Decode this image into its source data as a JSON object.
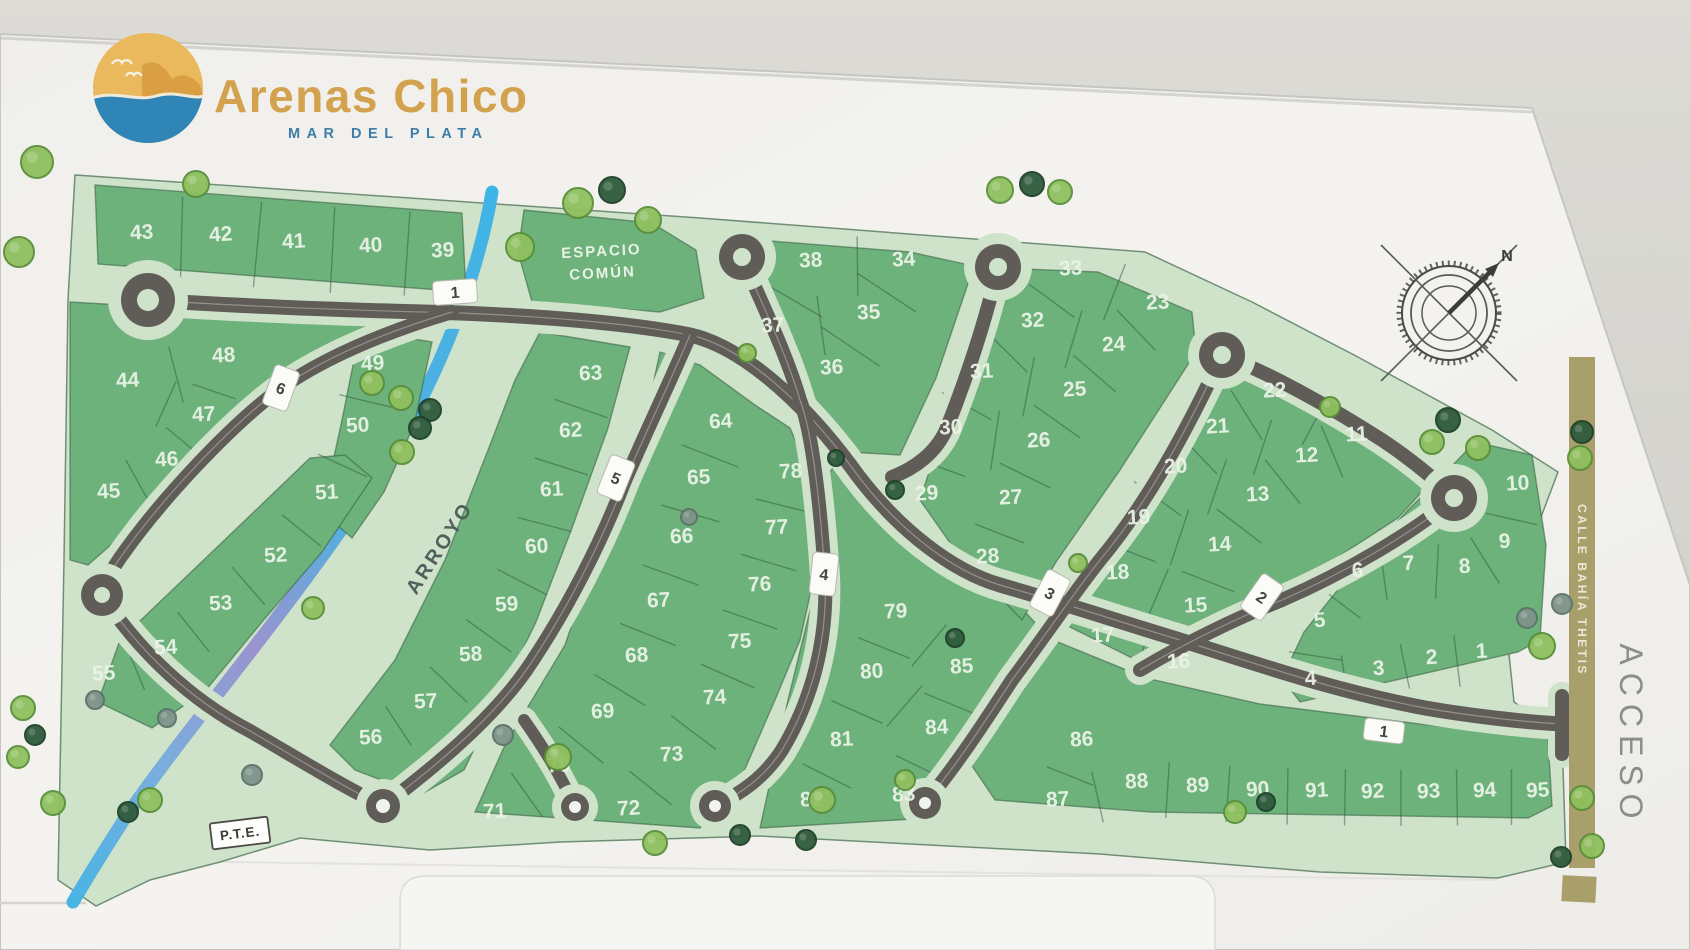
{
  "title": {
    "name": "Arenas Chico",
    "subtitle": "MAR DEL PLATA"
  },
  "map": {
    "common_space_line1": "ESPACIO",
    "common_space_line2": "COMÚN",
    "stream_label": "ARROYO",
    "street_side_label": "CALLE BAHÍA THETIS",
    "access_label": "ACCESO",
    "pte_label": "P.T.E.",
    "north_label": "N",
    "colors": {
      "lot_green": "#6db17b",
      "verge_green": "#cfe2ca",
      "road_gray": "#605c57",
      "stream_blue": "#41b4e6",
      "stream_lavender": "#9a93cf",
      "calle_olive": "#a89f6b",
      "brand_gold": "#d2a24f",
      "brand_blue": "#3c7ea7",
      "wall": "#d7d6d1",
      "board_white": "#f2f1ed",
      "tree_light": "#8fc05f",
      "tree_dark": "#2f5b3c",
      "tree_gray": "#7e938a"
    },
    "lots": [
      {
        "n": "43",
        "x": 142,
        "y": 239
      },
      {
        "n": "42",
        "x": 221,
        "y": 241
      },
      {
        "n": "41",
        "x": 294,
        "y": 248
      },
      {
        "n": "40",
        "x": 371,
        "y": 252
      },
      {
        "n": "39",
        "x": 443,
        "y": 257
      },
      {
        "n": "44",
        "x": 128,
        "y": 387
      },
      {
        "n": "48",
        "x": 224,
        "y": 362
      },
      {
        "n": "49",
        "x": 373,
        "y": 370
      },
      {
        "n": "47",
        "x": 204,
        "y": 421
      },
      {
        "n": "50",
        "x": 358,
        "y": 432
      },
      {
        "n": "46",
        "x": 167,
        "y": 466
      },
      {
        "n": "45",
        "x": 109,
        "y": 498
      },
      {
        "n": "51",
        "x": 327,
        "y": 499
      },
      {
        "n": "52",
        "x": 276,
        "y": 562
      },
      {
        "n": "53",
        "x": 221,
        "y": 610
      },
      {
        "n": "54",
        "x": 166,
        "y": 654
      },
      {
        "n": "55",
        "x": 104,
        "y": 680
      },
      {
        "n": "56",
        "x": 371,
        "y": 744
      },
      {
        "n": "57",
        "x": 426,
        "y": 708
      },
      {
        "n": "58",
        "x": 471,
        "y": 661
      },
      {
        "n": "59",
        "x": 507,
        "y": 611
      },
      {
        "n": "60",
        "x": 537,
        "y": 553
      },
      {
        "n": "61",
        "x": 552,
        "y": 496
      },
      {
        "n": "62",
        "x": 571,
        "y": 437
      },
      {
        "n": "63",
        "x": 591,
        "y": 380
      },
      {
        "n": "64",
        "x": 721,
        "y": 428
      },
      {
        "n": "65",
        "x": 699,
        "y": 484
      },
      {
        "n": "66",
        "x": 682,
        "y": 543
      },
      {
        "n": "67",
        "x": 659,
        "y": 607
      },
      {
        "n": "68",
        "x": 637,
        "y": 662
      },
      {
        "n": "69",
        "x": 603,
        "y": 718
      },
      {
        "n": "70",
        "x": 559,
        "y": 772
      },
      {
        "n": "71",
        "x": 495,
        "y": 818
      },
      {
        "n": "72",
        "x": 629,
        "y": 815
      },
      {
        "n": "73",
        "x": 672,
        "y": 761
      },
      {
        "n": "74",
        "x": 715,
        "y": 704
      },
      {
        "n": "75",
        "x": 740,
        "y": 648
      },
      {
        "n": "76",
        "x": 760,
        "y": 591
      },
      {
        "n": "77",
        "x": 777,
        "y": 534
      },
      {
        "n": "78",
        "x": 791,
        "y": 478
      },
      {
        "n": "38",
        "x": 811,
        "y": 267
      },
      {
        "n": "34",
        "x": 904,
        "y": 266
      },
      {
        "n": "37",
        "x": 773,
        "y": 332
      },
      {
        "n": "35",
        "x": 869,
        "y": 319
      },
      {
        "n": "36",
        "x": 832,
        "y": 374
      },
      {
        "n": "33",
        "x": 1071,
        "y": 275
      },
      {
        "n": "32",
        "x": 1033,
        "y": 327
      },
      {
        "n": "31",
        "x": 982,
        "y": 378
      },
      {
        "n": "30",
        "x": 951,
        "y": 434
      },
      {
        "n": "29",
        "x": 927,
        "y": 500
      },
      {
        "n": "28",
        "x": 988,
        "y": 563
      },
      {
        "n": "27",
        "x": 1011,
        "y": 504
      },
      {
        "n": "26",
        "x": 1039,
        "y": 447
      },
      {
        "n": "25",
        "x": 1075,
        "y": 396
      },
      {
        "n": "24",
        "x": 1114,
        "y": 351
      },
      {
        "n": "23",
        "x": 1158,
        "y": 309
      },
      {
        "n": "22",
        "x": 1275,
        "y": 397
      },
      {
        "n": "21",
        "x": 1218,
        "y": 433
      },
      {
        "n": "20",
        "x": 1176,
        "y": 473
      },
      {
        "n": "19",
        "x": 1139,
        "y": 524
      },
      {
        "n": "18",
        "x": 1118,
        "y": 579
      },
      {
        "n": "17",
        "x": 1103,
        "y": 642
      },
      {
        "n": "16",
        "x": 1179,
        "y": 668
      },
      {
        "n": "15",
        "x": 1196,
        "y": 612
      },
      {
        "n": "14",
        "x": 1220,
        "y": 551
      },
      {
        "n": "13",
        "x": 1258,
        "y": 501
      },
      {
        "n": "12",
        "x": 1307,
        "y": 462
      },
      {
        "n": "11",
        "x": 1357,
        "y": 441
      },
      {
        "n": "10",
        "x": 1518,
        "y": 490
      },
      {
        "n": "9",
        "x": 1505,
        "y": 548
      },
      {
        "n": "8",
        "x": 1465,
        "y": 573
      },
      {
        "n": "7",
        "x": 1409,
        "y": 570
      },
      {
        "n": "6",
        "x": 1358,
        "y": 577
      },
      {
        "n": "5",
        "x": 1320,
        "y": 627
      },
      {
        "n": "4",
        "x": 1311,
        "y": 685
      },
      {
        "n": "3",
        "x": 1379,
        "y": 675
      },
      {
        "n": "2",
        "x": 1432,
        "y": 664
      },
      {
        "n": "1",
        "x": 1482,
        "y": 658
      },
      {
        "n": "79",
        "x": 896,
        "y": 618
      },
      {
        "n": "80",
        "x": 872,
        "y": 678
      },
      {
        "n": "81",
        "x": 842,
        "y": 746
      },
      {
        "n": "82",
        "x": 812,
        "y": 806
      },
      {
        "n": "83",
        "x": 904,
        "y": 801
      },
      {
        "n": "84",
        "x": 937,
        "y": 734
      },
      {
        "n": "85",
        "x": 962,
        "y": 673
      },
      {
        "n": "86",
        "x": 1082,
        "y": 746
      },
      {
        "n": "87",
        "x": 1058,
        "y": 806
      },
      {
        "n": "88",
        "x": 1137,
        "y": 788
      },
      {
        "n": "89",
        "x": 1198,
        "y": 792
      },
      {
        "n": "90",
        "x": 1258,
        "y": 796
      },
      {
        "n": "91",
        "x": 1317,
        "y": 797
      },
      {
        "n": "92",
        "x": 1373,
        "y": 798
      },
      {
        "n": "93",
        "x": 1429,
        "y": 798
      },
      {
        "n": "94",
        "x": 1485,
        "y": 797
      },
      {
        "n": "95",
        "x": 1538,
        "y": 797
      }
    ],
    "road_signs": [
      {
        "n": "1",
        "x": 455,
        "y": 292,
        "rot": -4,
        "w": 44,
        "h": 24
      },
      {
        "n": "6",
        "x": 281,
        "y": 388,
        "rot": 20,
        "w": 26,
        "h": 42
      },
      {
        "n": "5",
        "x": 616,
        "y": 478,
        "rot": 22,
        "w": 26,
        "h": 42
      },
      {
        "n": "4",
        "x": 824,
        "y": 574,
        "rot": 6,
        "w": 26,
        "h": 42
      },
      {
        "n": "3",
        "x": 1050,
        "y": 593,
        "rot": 28,
        "w": 26,
        "h": 42
      },
      {
        "n": "2",
        "x": 1262,
        "y": 597,
        "rot": 35,
        "w": 26,
        "h": 42
      },
      {
        "n": "1",
        "x": 1384,
        "y": 731,
        "rot": 7,
        "w": 40,
        "h": 22
      }
    ],
    "divider_pairs": [
      [
        "43",
        "42",
        86
      ],
      [
        "42",
        "41",
        86
      ],
      [
        "41",
        "40",
        86
      ],
      [
        "40",
        "39",
        86
      ],
      [
        "44",
        "48",
        58
      ],
      [
        "48",
        "47",
        46
      ],
      [
        "44",
        "47",
        50
      ],
      [
        "47",
        "46",
        50
      ],
      [
        "46",
        "45",
        50
      ],
      [
        "49",
        "50",
        54
      ],
      [
        "50",
        "51",
        54
      ],
      [
        "51",
        "52",
        50
      ],
      [
        "52",
        "53",
        50
      ],
      [
        "53",
        "54",
        50
      ],
      [
        "54",
        "55",
        50
      ],
      [
        "63",
        "62",
        56
      ],
      [
        "62",
        "61",
        56
      ],
      [
        "61",
        "60",
        56
      ],
      [
        "60",
        "59",
        56
      ],
      [
        "59",
        "58",
        56
      ],
      [
        "58",
        "57",
        52
      ],
      [
        "57",
        "56",
        46
      ],
      [
        "64",
        "65",
        60
      ],
      [
        "65",
        "66",
        60
      ],
      [
        "66",
        "67",
        60
      ],
      [
        "67",
        "68",
        60
      ],
      [
        "68",
        "69",
        60
      ],
      [
        "69",
        "70",
        58
      ],
      [
        "70",
        "71",
        54
      ],
      [
        "72",
        "73",
        54
      ],
      [
        "73",
        "74",
        56
      ],
      [
        "74",
        "75",
        58
      ],
      [
        "75",
        "76",
        58
      ],
      [
        "76",
        "77",
        58
      ],
      [
        "77",
        "78",
        58
      ],
      [
        "38",
        "34",
        60
      ],
      [
        "37",
        "35",
        60
      ],
      [
        "38",
        "37",
        70
      ],
      [
        "34",
        "35",
        70
      ],
      [
        "35",
        "36",
        70
      ],
      [
        "33",
        "32",
        56
      ],
      [
        "32",
        "31",
        56
      ],
      [
        "31",
        "30",
        56
      ],
      [
        "30",
        "29",
        56
      ],
      [
        "23",
        "24",
        56
      ],
      [
        "24",
        "25",
        56
      ],
      [
        "25",
        "26",
        56
      ],
      [
        "26",
        "27",
        56
      ],
      [
        "27",
        "28",
        52
      ],
      [
        "33",
        "23",
        60
      ],
      [
        "32",
        "24",
        60
      ],
      [
        "31",
        "25",
        60
      ],
      [
        "30",
        "26",
        60
      ],
      [
        "22",
        "21",
        58
      ],
      [
        "21",
        "20",
        58
      ],
      [
        "20",
        "19",
        58
      ],
      [
        "19",
        "18",
        58
      ],
      [
        "18",
        "17",
        58
      ],
      [
        "11",
        "12",
        56
      ],
      [
        "12",
        "13",
        56
      ],
      [
        "13",
        "14",
        56
      ],
      [
        "14",
        "15",
        56
      ],
      [
        "15",
        "16",
        56
      ],
      [
        "22",
        "11",
        58
      ],
      [
        "21",
        "12",
        58
      ],
      [
        "20",
        "13",
        58
      ],
      [
        "19",
        "14",
        58
      ],
      [
        "18",
        "15",
        58
      ],
      [
        "17",
        "16",
        54
      ],
      [
        "10",
        "9",
        52
      ],
      [
        "9",
        "8",
        54
      ],
      [
        "8",
        "7",
        54
      ],
      [
        "7",
        "6",
        54
      ],
      [
        "6",
        "5",
        54
      ],
      [
        "5",
        "4",
        54
      ],
      [
        "4",
        "3",
        50
      ],
      [
        "3",
        "2",
        52
      ],
      [
        "2",
        "1",
        52
      ],
      [
        "79",
        "80",
        56
      ],
      [
        "80",
        "81",
        56
      ],
      [
        "81",
        "82",
        54
      ],
      [
        "85",
        "84",
        54
      ],
      [
        "84",
        "83",
        54
      ],
      [
        "79",
        "85",
        54
      ],
      [
        "80",
        "84",
        54
      ],
      [
        "86",
        "87",
        50
      ],
      [
        "87",
        "88",
        52
      ],
      [
        "88",
        "89",
        56
      ],
      [
        "89",
        "90",
        56
      ],
      [
        "90",
        "91",
        56
      ],
      [
        "91",
        "92",
        56
      ],
      [
        "92",
        "93",
        56
      ],
      [
        "93",
        "94",
        56
      ],
      [
        "94",
        "95",
        56
      ]
    ],
    "trees": [
      {
        "x": 37,
        "y": 162,
        "r": 16,
        "t": "L"
      },
      {
        "x": 19,
        "y": 252,
        "r": 15,
        "t": "L"
      },
      {
        "x": 196,
        "y": 184,
        "r": 13,
        "t": "L"
      },
      {
        "x": 520,
        "y": 247,
        "r": 14,
        "t": "L"
      },
      {
        "x": 578,
        "y": 203,
        "r": 15,
        "t": "L"
      },
      {
        "x": 612,
        "y": 190,
        "r": 13,
        "t": "D"
      },
      {
        "x": 648,
        "y": 220,
        "r": 13,
        "t": "L"
      },
      {
        "x": 747,
        "y": 353,
        "r": 9,
        "t": "L"
      },
      {
        "x": 372,
        "y": 383,
        "r": 12,
        "t": "L"
      },
      {
        "x": 401,
        "y": 398,
        "r": 12,
        "t": "L"
      },
      {
        "x": 430,
        "y": 410,
        "r": 11,
        "t": "D"
      },
      {
        "x": 420,
        "y": 428,
        "r": 11,
        "t": "D"
      },
      {
        "x": 402,
        "y": 452,
        "r": 12,
        "t": "L"
      },
      {
        "x": 313,
        "y": 608,
        "r": 11,
        "t": "L"
      },
      {
        "x": 503,
        "y": 735,
        "r": 10,
        "t": "G"
      },
      {
        "x": 558,
        "y": 757,
        "r": 13,
        "t": "L"
      },
      {
        "x": 655,
        "y": 843,
        "r": 12,
        "t": "L"
      },
      {
        "x": 740,
        "y": 835,
        "r": 10,
        "t": "D"
      },
      {
        "x": 806,
        "y": 840,
        "r": 10,
        "t": "D"
      },
      {
        "x": 822,
        "y": 800,
        "r": 13,
        "t": "L"
      },
      {
        "x": 1000,
        "y": 190,
        "r": 13,
        "t": "L"
      },
      {
        "x": 1032,
        "y": 184,
        "r": 12,
        "t": "D"
      },
      {
        "x": 1060,
        "y": 192,
        "r": 12,
        "t": "L"
      },
      {
        "x": 895,
        "y": 490,
        "r": 9,
        "t": "D"
      },
      {
        "x": 955,
        "y": 638,
        "r": 9,
        "t": "D"
      },
      {
        "x": 1078,
        "y": 563,
        "r": 9,
        "t": "L"
      },
      {
        "x": 1330,
        "y": 407,
        "r": 10,
        "t": "L"
      },
      {
        "x": 1448,
        "y": 420,
        "r": 12,
        "t": "D"
      },
      {
        "x": 1432,
        "y": 442,
        "r": 12,
        "t": "L"
      },
      {
        "x": 1478,
        "y": 448,
        "r": 12,
        "t": "L"
      },
      {
        "x": 1582,
        "y": 432,
        "r": 11,
        "t": "D"
      },
      {
        "x": 1580,
        "y": 458,
        "r": 12,
        "t": "L"
      },
      {
        "x": 1527,
        "y": 618,
        "r": 10,
        "t": "G"
      },
      {
        "x": 1562,
        "y": 604,
        "r": 10,
        "t": "G"
      },
      {
        "x": 1542,
        "y": 646,
        "r": 13,
        "t": "L"
      },
      {
        "x": 1582,
        "y": 798,
        "r": 12,
        "t": "L"
      },
      {
        "x": 1592,
        "y": 846,
        "r": 12,
        "t": "L"
      },
      {
        "x": 1561,
        "y": 857,
        "r": 10,
        "t": "D"
      },
      {
        "x": 23,
        "y": 708,
        "r": 12,
        "t": "L"
      },
      {
        "x": 35,
        "y": 735,
        "r": 10,
        "t": "D"
      },
      {
        "x": 18,
        "y": 757,
        "r": 11,
        "t": "L"
      },
      {
        "x": 53,
        "y": 803,
        "r": 12,
        "t": "L"
      },
      {
        "x": 95,
        "y": 700,
        "r": 9,
        "t": "G"
      },
      {
        "x": 252,
        "y": 775,
        "r": 10,
        "t": "G"
      },
      {
        "x": 167,
        "y": 718,
        "r": 9,
        "t": "G"
      },
      {
        "x": 150,
        "y": 800,
        "r": 12,
        "t": "L"
      },
      {
        "x": 128,
        "y": 812,
        "r": 10,
        "t": "D"
      },
      {
        "x": 689,
        "y": 517,
        "r": 8,
        "t": "G"
      },
      {
        "x": 836,
        "y": 458,
        "r": 8,
        "t": "D"
      },
      {
        "x": 1235,
        "y": 812,
        "r": 11,
        "t": "L"
      },
      {
        "x": 1266,
        "y": 802,
        "r": 9,
        "t": "D"
      },
      {
        "x": 905,
        "y": 780,
        "r": 10,
        "t": "L"
      }
    ]
  }
}
